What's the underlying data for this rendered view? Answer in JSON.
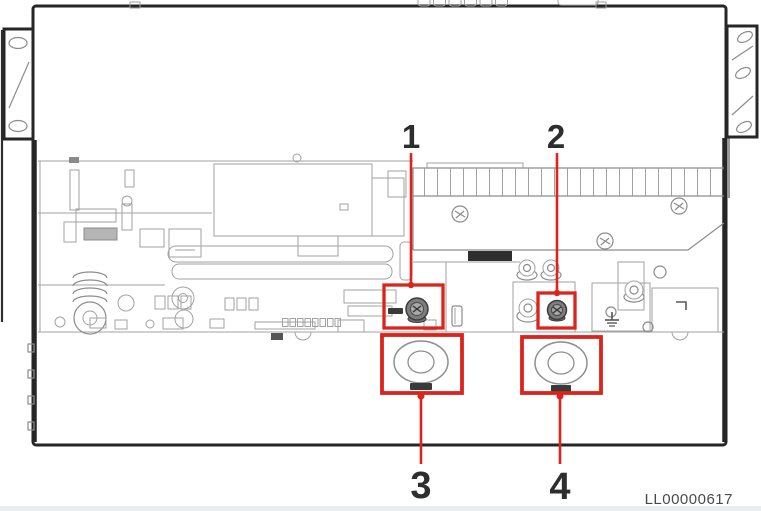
{
  "figure": {
    "callouts": [
      {
        "label": "1"
      },
      {
        "label": "2"
      },
      {
        "label": "3"
      },
      {
        "label": "4"
      }
    ],
    "figure_code": "LL00000617"
  },
  "colors": {
    "callout-red": "#db241b",
    "chassis-line": "#262626",
    "art-line": "#a2a2a2",
    "label-text": "#2e2e2e",
    "code-text": "#4a4a4a"
  }
}
